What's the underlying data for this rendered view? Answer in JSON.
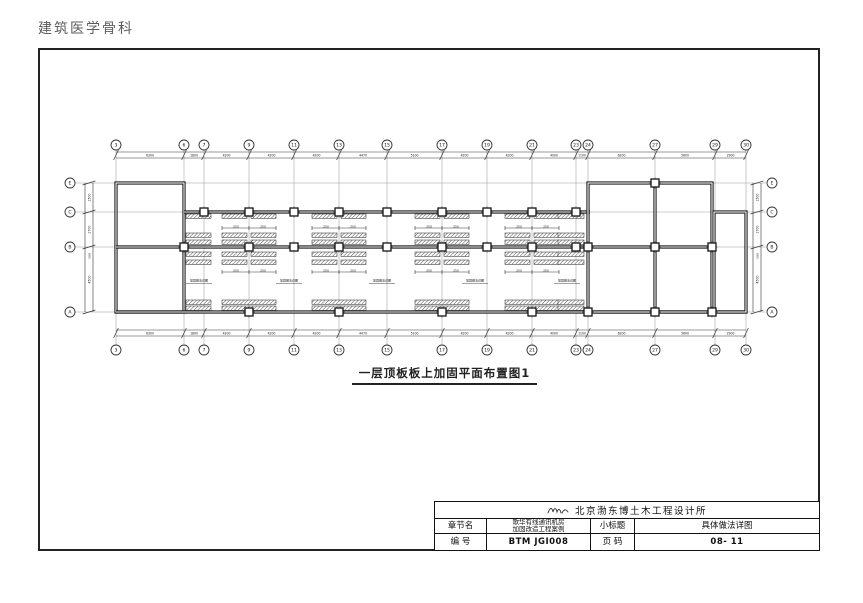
{
  "header": {
    "title": "建筑医学骨科"
  },
  "plan": {
    "caption": "一层顶板板上加固平面布置图1",
    "grid_cols": [
      {
        "label": "3",
        "x": 116
      },
      {
        "label": "6",
        "x": 184
      },
      {
        "label": "7",
        "x": 204
      },
      {
        "label": "9",
        "x": 249
      },
      {
        "label": "11",
        "x": 294
      },
      {
        "label": "13",
        "x": 339
      },
      {
        "label": "15",
        "x": 387
      },
      {
        "label": "17",
        "x": 442
      },
      {
        "label": "19",
        "x": 487
      },
      {
        "label": "21",
        "x": 532
      },
      {
        "label": "23",
        "x": 576
      },
      {
        "label": "24",
        "x": 588
      },
      {
        "label": "27",
        "x": 655
      },
      {
        "label": "29",
        "x": 715
      },
      {
        "label": "30",
        "x": 746
      }
    ],
    "grid_rows": [
      {
        "label": "E",
        "y": 183
      },
      {
        "label": "C",
        "y": 212
      },
      {
        "label": "B",
        "y": 247
      },
      {
        "label": "A",
        "y": 312
      }
    ],
    "top_dims": [
      "6300",
      "1800",
      "4200",
      "4200",
      "4200",
      "4470",
      "5100",
      "4200",
      "4200",
      "4000",
      "1100",
      "6200",
      "5600",
      "2900"
    ],
    "bottom_dims": [
      "6300",
      "1800",
      "4200",
      "4200",
      "4200",
      "4470",
      "5100",
      "4200",
      "4200",
      "4000",
      "1100",
      "6200",
      "5600",
      "2900"
    ],
    "left_dims": [
      "1500",
      "2700",
      "4500"
    ],
    "right_dims": [
      "1500",
      "2700",
      "4500"
    ],
    "side_note": "500",
    "overall_note": "4.18",
    "strip_dim": "250",
    "annotation": "加固做法详图",
    "module_centers": [
      249,
      339,
      442,
      532
    ],
    "annotation_xs": [
      186,
      276,
      369,
      462,
      554
    ]
  },
  "title_block": {
    "company": "北京渤东博土木工程设计所",
    "row1": {
      "label1": "章节名",
      "project_line1": "歌华有线通讯机房",
      "project_line2": "加固改造工程案例",
      "label2": "小标题",
      "value2": "具体做法详图"
    },
    "row2": {
      "label1": "编  号",
      "value1": "BTM JGI008",
      "label2": "页  码",
      "value2": "08- 11"
    }
  }
}
